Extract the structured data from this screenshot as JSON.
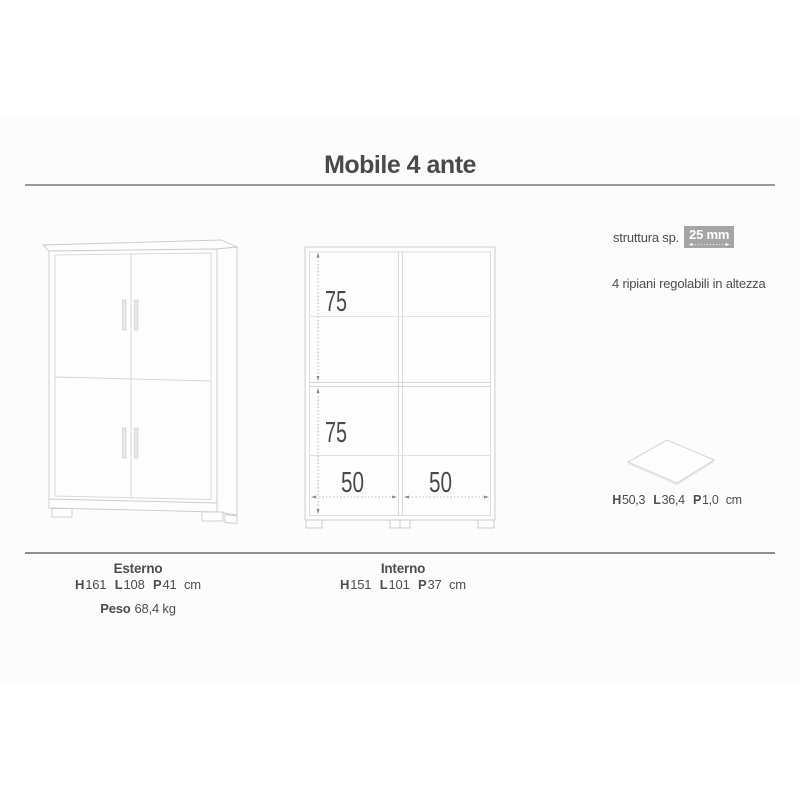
{
  "document": {
    "title": "Mobile 4 ante"
  },
  "specs": {
    "structure_label": "struttura sp.",
    "structure_value": "25 mm",
    "shelves_note": "4 ripiani regolabili in altezza"
  },
  "shelf": {
    "h_label": "H",
    "h_value": "50,3",
    "l_label": "L",
    "l_value": "36,4",
    "p_label": "P",
    "p_value": "1,0",
    "unit": "cm"
  },
  "interior_drawing": {
    "upper_height": "75",
    "lower_height": "75",
    "left_width": "50",
    "right_width": "50"
  },
  "footer": {
    "exterior": {
      "title": "Esterno",
      "h_label": "H",
      "h_value": "161",
      "l_label": "L",
      "l_value": "108",
      "p_label": "P",
      "p_value": "41",
      "unit": "cm",
      "weight_label": "Peso",
      "weight_value": "68,4 kg"
    },
    "interior": {
      "title": "Interno",
      "h_label": "H",
      "h_value": "151",
      "l_label": "L",
      "l_value": "101",
      "p_label": "P",
      "p_value": "37",
      "unit": "cm"
    }
  },
  "colors": {
    "text": "#4d4d4d",
    "drawing_line": "#c9cccc",
    "badge_background": "#a5a5a5",
    "badge_text": "#ffffff",
    "rule": "#9a9a9a"
  }
}
